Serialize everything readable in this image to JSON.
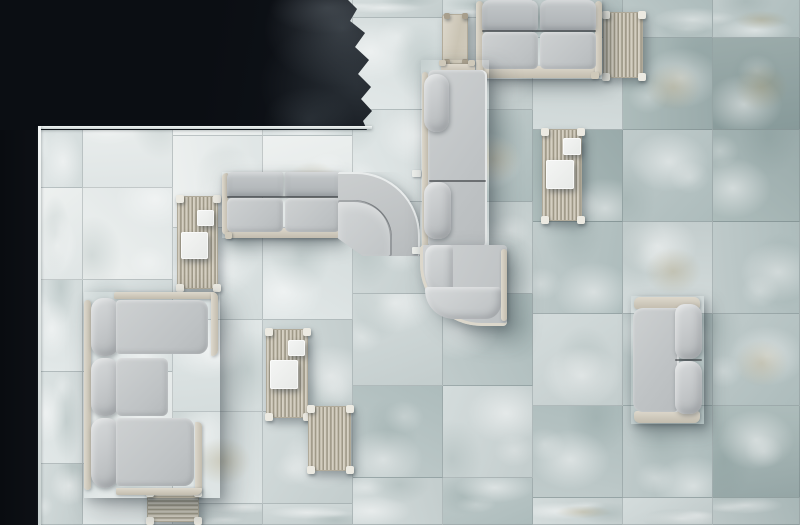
{
  "scene": {
    "description": "top-down render: gray modular outdoor sofas and slatted wood tables on pale green-gray stone tiles beside a dark pool",
    "canvas": {
      "w": 800,
      "h": 525
    },
    "colors": {
      "water": "#0a0d11",
      "water_ripple": "#8c98a0",
      "deck_edge": "#f4f7f6",
      "tile_seam": "#606e70",
      "tile_light": "#eef1f0",
      "tile_mid": "#c0cbcb",
      "tile_dark": "#879a9a",
      "tile_ochre": "#a89464",
      "sofa_fabric": "#c6c9cb",
      "sofa_fabric_dark": "#acb1b4",
      "frame_wood": "#cfc9bb",
      "slat_dark": "#938d7b",
      "tray_white": "#f1f2f1"
    },
    "floor": {
      "col_bounds": [
        38,
        83,
        173,
        263,
        353,
        443,
        533,
        623,
        713,
        800
      ],
      "row_step": 92,
      "col_offset": [
        4,
        4,
        44,
        44,
        18,
        18,
        38,
        38,
        38
      ],
      "variant_map": [
        [
          1,
          0,
          1,
          0,
          1,
          1,
          2,
          1
        ],
        [
          0,
          0,
          0,
          0,
          1,
          0,
          1,
          1
        ],
        [
          1,
          0,
          0,
          1,
          1,
          1,
          2,
          2
        ],
        [
          1,
          1,
          0,
          1,
          2,
          2,
          2,
          2
        ],
        [
          2,
          1,
          1,
          2,
          2,
          3,
          2,
          3
        ],
        [
          2,
          2,
          3,
          2,
          3,
          2,
          3,
          3
        ],
        [
          3,
          2,
          4,
          3,
          2,
          3,
          2,
          3
        ],
        [
          3,
          4,
          3,
          2,
          3,
          3,
          2,
          3
        ],
        [
          3,
          5,
          4,
          3,
          3,
          4,
          3,
          4
        ]
      ]
    },
    "water": {
      "left": {
        "name": "pool-water-left",
        "r": [
          0,
          0,
          38,
          525
        ]
      },
      "top": {
        "name": "pool-water-top",
        "r": [
          0,
          0,
          372,
          130
        ],
        "clip": "polygon(0 0,348px 0,357px 9px,350px 21px,365px 33px,355px 47px,369px 60px,358px 74px,371px 87px,361px 99px,372px 111px,363px 121px,367px 130px,0 130px)"
      },
      "edges": [
        {
          "name": "deck-edge-horizontal",
          "r": [
            38,
            126,
            334,
            3
          ]
        },
        {
          "name": "deck-edge-vertical",
          "r": [
            38,
            126,
            3,
            399
          ]
        }
      ]
    },
    "items": [
      {
        "name": "slatted-coffee-table-bottom-left",
        "cls": "slath shadow-sm",
        "r": [
          147,
          490,
          52,
          32
        ],
        "feet": true
      },
      {
        "name": "side-table-top",
        "cls": "woodtop shadow-sm",
        "r": [
          442,
          14,
          26,
          50
        ],
        "parts": [
          {
            "name": "table-leg",
            "cls": "tleg",
            "r": [
              1,
              44,
              6,
              9
            ]
          },
          {
            "name": "table-leg",
            "cls": "tleg",
            "r": [
              19,
              44,
              6,
              9
            ]
          },
          {
            "name": "table-leg",
            "cls": "tleg",
            "r": [
              1,
              -2,
              6,
              6
            ]
          },
          {
            "name": "table-leg",
            "cls": "tleg",
            "r": [
              19,
              -2,
              6,
              6
            ]
          }
        ]
      },
      {
        "name": "slatted-side-table-top-right",
        "cls": "slatv shadow-sm",
        "r": [
          603,
          12,
          40,
          66
        ],
        "feet": true
      },
      {
        "name": "slatted-coffee-table-left",
        "cls": "slatv shadow-sm",
        "r": [
          177,
          196,
          41,
          93
        ],
        "feet": true,
        "parts": [
          {
            "name": "serving-tray-small",
            "cls": "tray",
            "r": [
              19,
              13,
              17,
              16
            ]
          },
          {
            "name": "serving-tray-large",
            "cls": "tray",
            "r": [
              3,
              35,
              27,
              27
            ]
          }
        ]
      },
      {
        "name": "slatted-coffee-table-right",
        "cls": "slatv shadow-sm",
        "r": [
          542,
          129,
          40,
          92
        ],
        "feet": true,
        "parts": [
          {
            "name": "serving-tray-small",
            "cls": "tray",
            "r": [
              20,
              8,
              18,
              17
            ]
          },
          {
            "name": "serving-tray-large",
            "cls": "tray",
            "r": [
              3,
              30,
              28,
              29
            ]
          }
        ]
      },
      {
        "name": "slatted-coffee-table-center",
        "cls": "slatv shadow-sm",
        "r": [
          266,
          329,
          42,
          89
        ],
        "feet": true,
        "parts": [
          {
            "name": "serving-tray-small",
            "cls": "tray",
            "r": [
              21,
              10,
              17,
              16
            ]
          },
          {
            "name": "serving-tray-large",
            "cls": "tray",
            "r": [
              3,
              30,
              28,
              29
            ]
          }
        ]
      },
      {
        "name": "slatted-side-table-lower",
        "cls": "slatv shadow-sm",
        "r": [
          308,
          406,
          43,
          65
        ],
        "feet": true
      },
      {
        "name": "two-seat-sofa-top",
        "cls": "sofa shadow-md",
        "r": [
          476,
          0,
          126,
          79
        ],
        "parts": [
          {
            "name": "sofa-base-rail",
            "cls": "rail",
            "r": [
              5,
              66,
              116,
              12
            ]
          },
          {
            "name": "sofa-arm-left",
            "cls": "railv",
            "r": [
              0,
              1,
              7,
              75
            ]
          },
          {
            "name": "sofa-arm-right",
            "cls": "railv",
            "r": [
              119,
              1,
              7,
              75
            ]
          },
          {
            "name": "sofa-foot",
            "cls": "foot",
            "r": [
              3,
              72,
              8,
              7
            ]
          },
          {
            "name": "sofa-foot",
            "cls": "foot",
            "r": [
              115,
              72,
              8,
              7
            ]
          },
          {
            "name": "back-cushion",
            "cls": "backband",
            "r": [
              6,
              0,
              56,
              31
            ],
            "rad": "8px 8px 4px 4px"
          },
          {
            "name": "back-cushion",
            "cls": "backband",
            "r": [
              64,
              0,
              56,
              31
            ],
            "rad": "8px 8px 4px 4px"
          },
          {
            "name": "seat-cushion",
            "cls": "seat",
            "r": [
              6,
              32,
              56,
              37
            ]
          },
          {
            "name": "seat-cushion",
            "cls": "seat",
            "r": [
              64,
              32,
              56,
              37
            ]
          },
          {
            "name": "seam-line",
            "cls": "seam",
            "r": [
              6,
              30,
              114,
              2
            ]
          }
        ]
      },
      {
        "name": "sofa-straight-module-middle",
        "cls": "sofa shadow-md",
        "r": [
          222,
          172,
          118,
          66
        ],
        "parts": [
          {
            "name": "sofa-base-rail",
            "cls": "rail",
            "r": [
              4,
              56,
              114,
              10
            ]
          },
          {
            "name": "sofa-arm-left",
            "cls": "railv",
            "r": [
              0,
              1,
              6,
              62
            ],
            "rad": "6px 2px 2px 6px"
          },
          {
            "name": "back-cushion",
            "cls": "backband",
            "r": [
              5,
              0,
              56,
              25
            ],
            "rad": "6px 2px 2px 2px"
          },
          {
            "name": "back-cushion",
            "cls": "backband",
            "r": [
              63,
              0,
              55,
              25
            ],
            "rad": "2px"
          },
          {
            "name": "seat-cushion",
            "cls": "seat",
            "r": [
              5,
              26,
              56,
              34
            ]
          },
          {
            "name": "seat-cushion",
            "cls": "seat",
            "r": [
              63,
              26,
              55,
              34
            ]
          },
          {
            "name": "seam-line",
            "cls": "seam",
            "r": [
              5,
              24,
              113,
              2
            ]
          },
          {
            "name": "sofa-foot",
            "cls": "foot",
            "r": [
              3,
              60,
              7,
              7
            ]
          }
        ]
      },
      {
        "name": "sofa-corner-module",
        "cls": "sofa corner-mod shadow-md",
        "r": [
          338,
          172,
          82,
          84
        ],
        "rad": "2px 64px 2px 2px",
        "clip": "polygon(0 0,100% 0,100% 100%,30% 100%,0 79%)",
        "parts": [
          {
            "name": "corner-seat",
            "cls": "corner-seat",
            "r": [
              0,
              26,
              54,
              56
            ],
            "rad": "2px 38px 2px 2px"
          }
        ]
      },
      {
        "name": "module-connector",
        "cls": "connector",
        "r": [
          412,
          170,
          9,
          7
        ]
      },
      {
        "name": "module-connector",
        "cls": "connector",
        "r": [
          412,
          247,
          9,
          7
        ]
      },
      {
        "name": "sofa-bench-vertical",
        "cls": "sofa shadow-lg",
        "r": [
          421,
          60,
          68,
          188
        ],
        "parts": [
          {
            "name": "bench-top-rail",
            "cls": "rail",
            "r": [
              20,
              4,
              34,
              9
            ]
          },
          {
            "name": "bench-foot",
            "cls": "foot",
            "r": [
              18,
              0,
              7,
              6
            ]
          },
          {
            "name": "bench-foot",
            "cls": "foot",
            "r": [
              47,
              0,
              7,
              6
            ]
          },
          {
            "name": "bench-side-rail",
            "cls": "railv",
            "r": [
              1,
              12,
              6,
              176
            ]
          },
          {
            "name": "bench-deck",
            "cls": "deck",
            "r": [
              7,
              10,
              59,
              178
            ]
          },
          {
            "name": "seam-line",
            "cls": "seam",
            "r": [
              8,
              120,
              57,
              2
            ]
          },
          {
            "name": "back-bolster",
            "cls": "cushion",
            "r": [
              3,
              14,
              25,
              58
            ],
            "rad": "12px"
          },
          {
            "name": "back-bolster",
            "cls": "cushion",
            "r": [
              3,
              122,
              27,
              57
            ],
            "rad": "12px"
          }
        ]
      },
      {
        "name": "sofa-curved-module",
        "cls": "sofa curve-mod shadow-lg",
        "r": [
          420,
          245,
          87,
          81
        ],
        "rad": "4px 4px 4px 62px",
        "parts": [
          {
            "name": "curve-roll-vertical",
            "cls": "curve-roll",
            "r": [
              2,
              0,
              28,
              52
            ],
            "rad": "12px 4px 4px 30px"
          },
          {
            "name": "curve-roll-bottom",
            "cls": "curve-roll",
            "r": [
              2,
              42,
              76,
              32
            ],
            "rad": "4px 4px 22px 42px"
          },
          {
            "name": "curve-end-rail",
            "cls": "railv",
            "r": [
              78,
              4,
              6,
              72
            ]
          }
        ]
      },
      {
        "name": "two-seat-sofa-right",
        "cls": "sofa shadow-md",
        "r": [
          631,
          296,
          73,
          128
        ],
        "parts": [
          {
            "name": "sofa-arm-top",
            "cls": "rail",
            "r": [
              3,
              1,
              66,
              12
            ],
            "rad": "6px 6px 3px 3px"
          },
          {
            "name": "sofa-arm-bottom",
            "cls": "rail",
            "r": [
              3,
              115,
              66,
              12
            ],
            "rad": "3px 3px 6px 6px"
          },
          {
            "name": "sofa-deck",
            "cls": "deck",
            "r": [
              2,
              12,
              46,
              104
            ],
            "rad": "10px 3px 3px 10px"
          },
          {
            "name": "back-cushion",
            "cls": "cushion",
            "r": [
              44,
              8,
              27,
              55
            ],
            "rad": "10px 12px 12px 10px"
          },
          {
            "name": "back-cushion",
            "cls": "cushion",
            "r": [
              44,
              65,
              27,
              53
            ],
            "rad": "10px 12px 12px 10px"
          },
          {
            "name": "seam-line",
            "cls": "seam",
            "r": [
              44,
              63,
              27,
              2
            ]
          }
        ]
      },
      {
        "name": "sectional-sofa-left",
        "cls": "sofa shadow-lg",
        "r": [
          84,
          292,
          136,
          206
        ],
        "parts": [
          {
            "name": "spine-rail",
            "cls": "railv",
            "r": [
              0,
              8,
              7,
              190
            ]
          },
          {
            "name": "back-bolster",
            "cls": "cushion",
            "r": [
              7,
              6,
              28,
              58
            ],
            "rad": "12px"
          },
          {
            "name": "back-bolster",
            "cls": "cushion",
            "r": [
              7,
              66,
              28,
              58
            ],
            "rad": "12px"
          },
          {
            "name": "back-bolster",
            "cls": "cushion",
            "r": [
              7,
              126,
              28,
              70
            ],
            "rad": "12px 12px 14px 14px"
          },
          {
            "name": "chaise-rail-top",
            "cls": "rail",
            "r": [
              30,
              0,
              104,
              7
            ],
            "rad": "4px 10px 2px 2px"
          },
          {
            "name": "chaise-rail-right",
            "cls": "railv",
            "r": [
              127,
              0,
              7,
              64
            ],
            "rad": "2px 10px 10px 2px"
          },
          {
            "name": "chaise-cushion-top",
            "cls": "seat",
            "r": [
              32,
              8,
              92,
              54
            ],
            "rad": "4px 10px 10px 4px"
          },
          {
            "name": "mid-seat-cushion",
            "cls": "seat",
            "r": [
              32,
              66,
              52,
              58
            ],
            "rad": "6px"
          },
          {
            "name": "chaise-cushion-bottom",
            "cls": "seat",
            "r": [
              32,
              126,
              78,
              68
            ],
            "rad": "4px 10px 10px 4px"
          },
          {
            "name": "chaise-rail-right2",
            "cls": "railv",
            "r": [
              111,
              130,
              7,
              72
            ],
            "rad": "2px 10px 14px 2px"
          },
          {
            "name": "chaise-rail-bottom",
            "cls": "rail",
            "r": [
              32,
              196,
              86,
              7
            ],
            "rad": "2px 2px 12px 4px"
          }
        ]
      },
      {
        "name": "vignette-overlay",
        "cls": "vignette",
        "r": [
          0,
          0,
          800,
          525
        ]
      }
    ]
  }
}
